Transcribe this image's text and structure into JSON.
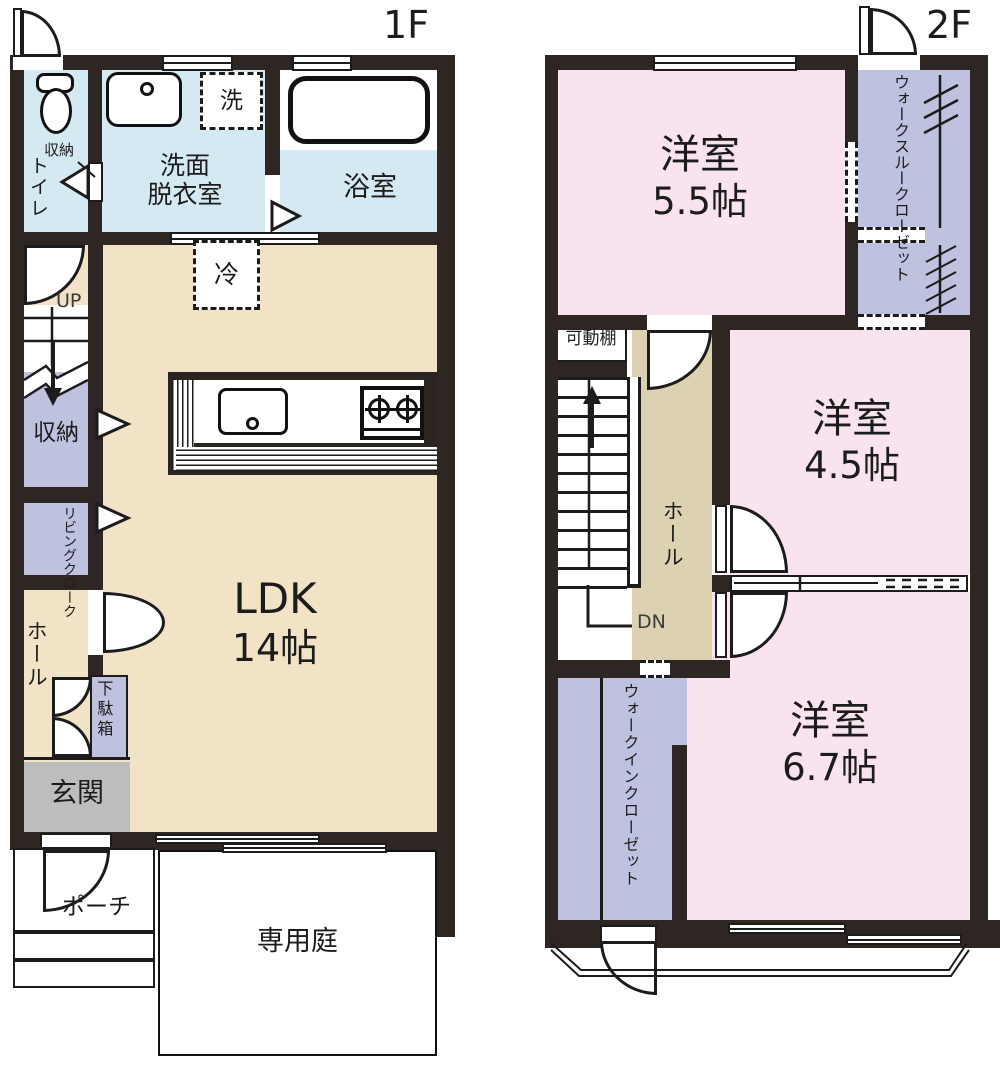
{
  "colors": {
    "wall": "#2e2623",
    "floor_wood": "#f2e3c6",
    "hall_2f": "#dcd2b2",
    "water_blue": "#d5e9f2",
    "closet_lavender": "#bfc2de",
    "room_pink": "#f8e3ee",
    "entrance_gray": "#bdbdbd"
  },
  "floor1": {
    "title": "1F",
    "toilet": {
      "name": "トイレ",
      "shelf": "収納"
    },
    "washroom": {
      "line1": "洗面",
      "line2": "脱衣室"
    },
    "bath": {
      "name": "浴室"
    },
    "washer": "洗",
    "fridge": "冷",
    "stairs_up": "UP",
    "storage": "収納",
    "living_cloak": "リビングクローク",
    "hall": "ホール",
    "shoe_box": "下駄箱",
    "entrance": "玄関",
    "ldk": {
      "line1": "LDK",
      "line2": "14帖"
    },
    "porch": "ポーチ",
    "garden": "専用庭"
  },
  "floor2": {
    "title": "2F",
    "room_55": {
      "line1": "洋室",
      "line2": "5.5帖"
    },
    "walk_through_closet": "ウォークスルークローゼット",
    "movable_shelf": "可動棚",
    "room_45": {
      "line1": "洋室",
      "line2": "4.5帖"
    },
    "hall": "ホール",
    "stairs_down": "DN",
    "walk_in_closet": "ウォークインクローゼット",
    "room_67": {
      "line1": "洋室",
      "line2": "6.7帖"
    }
  }
}
